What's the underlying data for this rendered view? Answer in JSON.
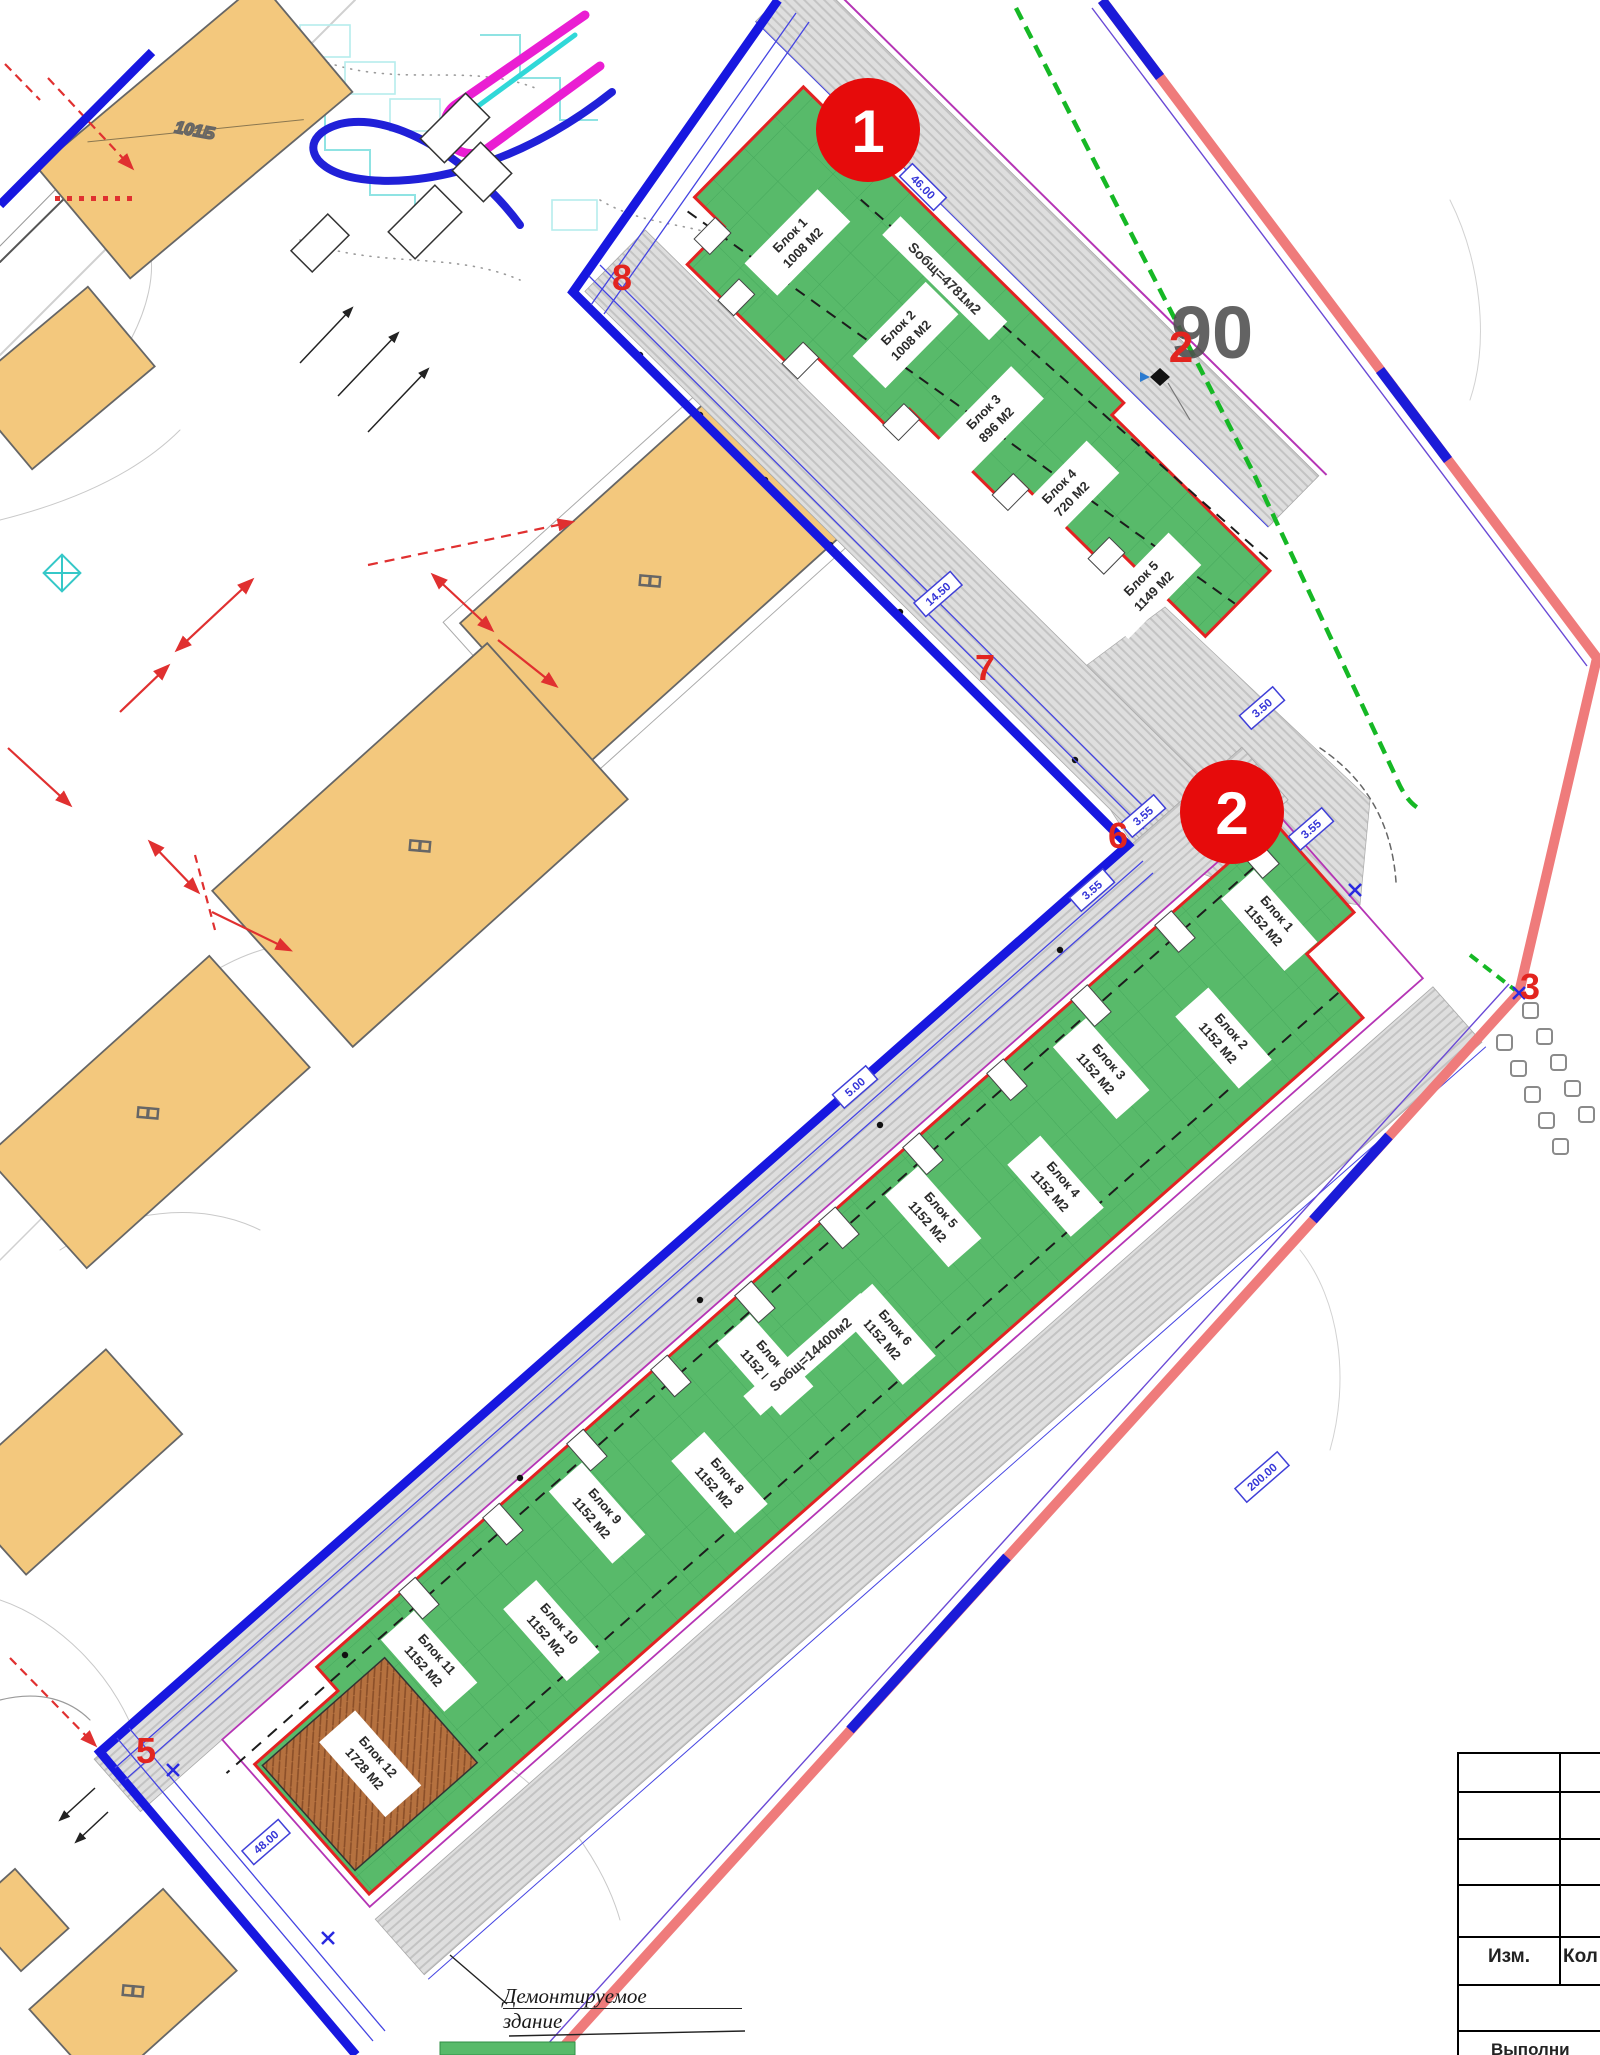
{
  "markers": {
    "m1": "1",
    "m2": "2"
  },
  "plan": {
    "area_label_90": "90",
    "vertices": {
      "v2": "2",
      "v3": "3",
      "v5": "5",
      "v6": "6",
      "v7": "7",
      "v8": "8"
    }
  },
  "area1": {
    "total_area_label": "Sобщ=4781м2",
    "blocks": [
      {
        "name": "Блок 1",
        "area": "1008 М2"
      },
      {
        "name": "Блок 2",
        "area": "1008 М2"
      },
      {
        "name": "Блок 3",
        "area": "896 М2"
      },
      {
        "name": "Блок 4",
        "area": "720 М2"
      },
      {
        "name": "Блок 5",
        "area": "1149 М2"
      }
    ]
  },
  "area2": {
    "total_area_label": "Sобщ=14400м2",
    "blocks": [
      {
        "name": "Блок 1",
        "area": "1152 М2"
      },
      {
        "name": "Блок 2",
        "area": "1152 М2"
      },
      {
        "name": "Блок 3",
        "area": "1152 М2"
      },
      {
        "name": "Блок 4",
        "area": "1152 М2"
      },
      {
        "name": "Блок 5",
        "area": "1152 М2"
      },
      {
        "name": "Блок 6",
        "area": "1152 М2"
      },
      {
        "name": "Блок 7",
        "area": "1152 М2"
      },
      {
        "name": "Блок 8",
        "area": "1152 М2"
      },
      {
        "name": "Блок 9",
        "area": "1152 М2"
      },
      {
        "name": "Блок 10",
        "area": "1152 М2"
      },
      {
        "name": "Блок 11",
        "area": "1152 М2"
      },
      {
        "name": "Блок 12",
        "area": "1728 М2"
      }
    ]
  },
  "buildings": {
    "label_101": "101Б",
    "label_sq": "□□"
  },
  "dimensions": {
    "d1": "46.00",
    "d2": "14.50",
    "d3": "3.50",
    "d4": "3.55",
    "d5": "3.55",
    "d6": "3.55",
    "d7": "5.00",
    "d8": "200.00",
    "d9": "48.00"
  },
  "callout": {
    "line1": "Демонтируемое",
    "line2": "здание"
  },
  "title_block": {
    "col_izm": "Изм.",
    "col_kol": "Кол",
    "row_bottom": "Выполни"
  },
  "colors": {
    "boundary_blue": "#1717e0",
    "border_salmon": "#ef7b7b",
    "block_green": "#58ba6a",
    "building_orange": "#f3c87d",
    "marker_red": "#e60b0b",
    "outline_red": "#e32222",
    "utility_green": "#16b825",
    "purple_line": "#b535b5"
  }
}
